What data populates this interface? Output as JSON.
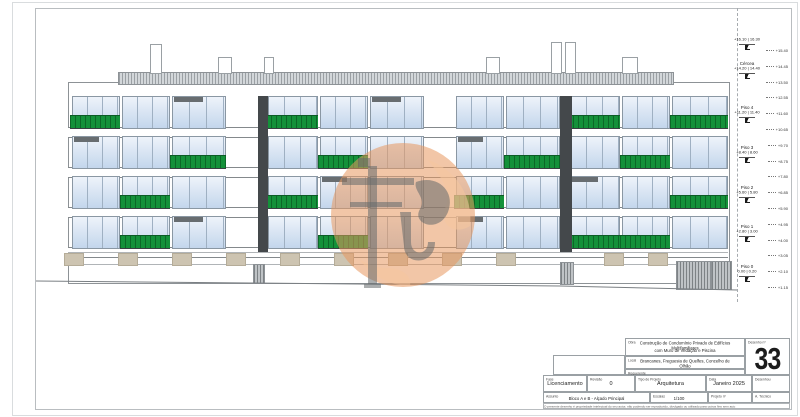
{
  "sheet": {
    "drawing_number": "33"
  },
  "colors": {
    "railing_green": "#14913a",
    "glass_light": "#eef3fa",
    "glass_dark": "#c3d6ec",
    "slot_dark": "#44484b",
    "pilaster_beige": "#cdc4b1",
    "watermark_orange": "#e8985f",
    "watermark_gray": "#6e7376"
  },
  "title_block": {
    "obra_label": "Obra",
    "obra_line1": "Construção de Condomínio Privado de Edifícios Multifamiliares",
    "obra_line2": "com Muro de Vedação e Piscina",
    "local_label": "Local",
    "local": "Brancanes, Freguesia de Quelfes, Concelho de Olhão",
    "requerente_label": "Requerente",
    "requerente": "",
    "fase_label": "Fase",
    "fase": "Licenciamento",
    "revisao_label": "Revisão",
    "revisao": "0",
    "tipo_label": "Tipo de Projeto",
    "tipo": "Arquitetura",
    "data_label": "Data",
    "data": "Janeiro 2025",
    "desenhou_label": "Desenhou",
    "desenhou": "",
    "assunto_label": "Assunto",
    "assunto": "Bloco A e B - Alçado Principal",
    "escalas_label": "Escalas",
    "escalas": "1/100",
    "projeto_label": "Projeto nº",
    "projeto": "",
    "tecnico_label": "A. Técnico",
    "tecnico": "",
    "desenho_num_label": "Desenho nº",
    "desenho_num": "33",
    "disclaimer": "O presente desenho é propriedade intelectual do seu autor, não podendo ser reproduzido, divulgado ou utilizado para outros fins sem autorização prévia, nos termos da legislação em vigor, ao abrigo do CDADC, DL nº 63/85 de 14 de Março."
  },
  "levels": [
    {
      "label": "",
      "value": "+16.10 | 16.30",
      "y": 38
    },
    {
      "label": "Cércea",
      "value": "+14.20 | 14.40",
      "y": 62
    },
    {
      "label": "Piso 4",
      "value": "+11.20 | 11.40",
      "y": 106
    },
    {
      "label": "Piso 3",
      "value": "+8.40 | 8.60",
      "y": 146
    },
    {
      "label": "Piso 2",
      "value": "+5.60 | 5.80",
      "y": 186
    },
    {
      "label": "Piso 1",
      "value": "+2.80 | 3.00",
      "y": 225
    },
    {
      "label": "Piso 0",
      "value": "0.00 | 0.20",
      "y": 265
    }
  ],
  "side_marks": [
    "+15.40",
    "+14.45",
    "+13.50",
    "+12.55",
    "+11.60",
    "+10.65",
    "+9.70",
    "+8.75",
    "+7.80",
    "+6.85",
    "+5.90",
    "+4.95",
    "+4.00",
    "+3.05",
    "+2.10",
    "+1.15"
  ],
  "facade": {
    "building": {
      "x": 68,
      "y": 82,
      "w": 660,
      "h": 200
    },
    "roof_hatch": {
      "x": 118,
      "y": 72,
      "w": 554,
      "h": 11
    },
    "chimneys": [
      {
        "x": 150,
        "y": 44,
        "w": 10,
        "h": 28
      },
      {
        "x": 218,
        "y": 57,
        "w": 12,
        "h": 15
      },
      {
        "x": 264,
        "y": 57,
        "w": 8,
        "h": 15
      },
      {
        "x": 486,
        "y": 57,
        "w": 12,
        "h": 15
      },
      {
        "x": 551,
        "y": 42,
        "w": 9,
        "h": 30
      },
      {
        "x": 565,
        "y": 42,
        "w": 9,
        "h": 30
      },
      {
        "x": 622,
        "y": 57,
        "w": 14,
        "h": 15
      }
    ],
    "columns": [
      {
        "x": 72,
        "w": 46
      },
      {
        "x": 122,
        "w": 46
      },
      {
        "x": 172,
        "w": 52
      },
      {
        "x": 268,
        "w": 48
      },
      {
        "x": 320,
        "w": 46
      },
      {
        "x": 370,
        "w": 52
      },
      {
        "x": 456,
        "w": 46
      },
      {
        "x": 506,
        "w": 52
      },
      {
        "x": 570,
        "w": 48
      },
      {
        "x": 622,
        "w": 46
      },
      {
        "x": 672,
        "w": 54
      }
    ],
    "window_h": 31,
    "slab_h": 9,
    "floors": [
      {
        "y": 96,
        "railings": [
          0,
          3,
          8,
          10
        ],
        "dark_tops": [
          2,
          5
        ]
      },
      {
        "y": 136,
        "railings": [
          2,
          4,
          7,
          9
        ],
        "dark_tops": [
          0,
          6
        ]
      },
      {
        "y": 176,
        "railings": [
          1,
          3,
          6,
          10
        ],
        "dark_tops": [
          4,
          8
        ]
      },
      {
        "y": 216,
        "railings": [
          1,
          4,
          8,
          9
        ],
        "dark_tops": [
          2,
          6
        ]
      }
    ],
    "slots": [
      {
        "x": 258,
        "y": 96,
        "w": 10,
        "h": 156
      },
      {
        "x": 560,
        "y": 96,
        "w": 12,
        "h": 156
      }
    ],
    "ground": {
      "band_y": 252,
      "pilaster_h": 12,
      "pilaster_w": 18,
      "pilasters": [
        64,
        118,
        172,
        226,
        280,
        334,
        388,
        442,
        496,
        604,
        648
      ],
      "doors": [
        {
          "x": 253,
          "y": 264,
          "w": 10,
          "h": 18
        },
        {
          "x": 560,
          "y": 262,
          "w": 12,
          "h": 21
        }
      ],
      "garages": [
        {
          "x": 676,
          "y": 261,
          "w": 33,
          "h": 27
        },
        {
          "x": 711,
          "y": 261,
          "w": 19,
          "h": 27
        }
      ],
      "terrain_points": "36,281 250,283 560,286 737,290"
    }
  }
}
